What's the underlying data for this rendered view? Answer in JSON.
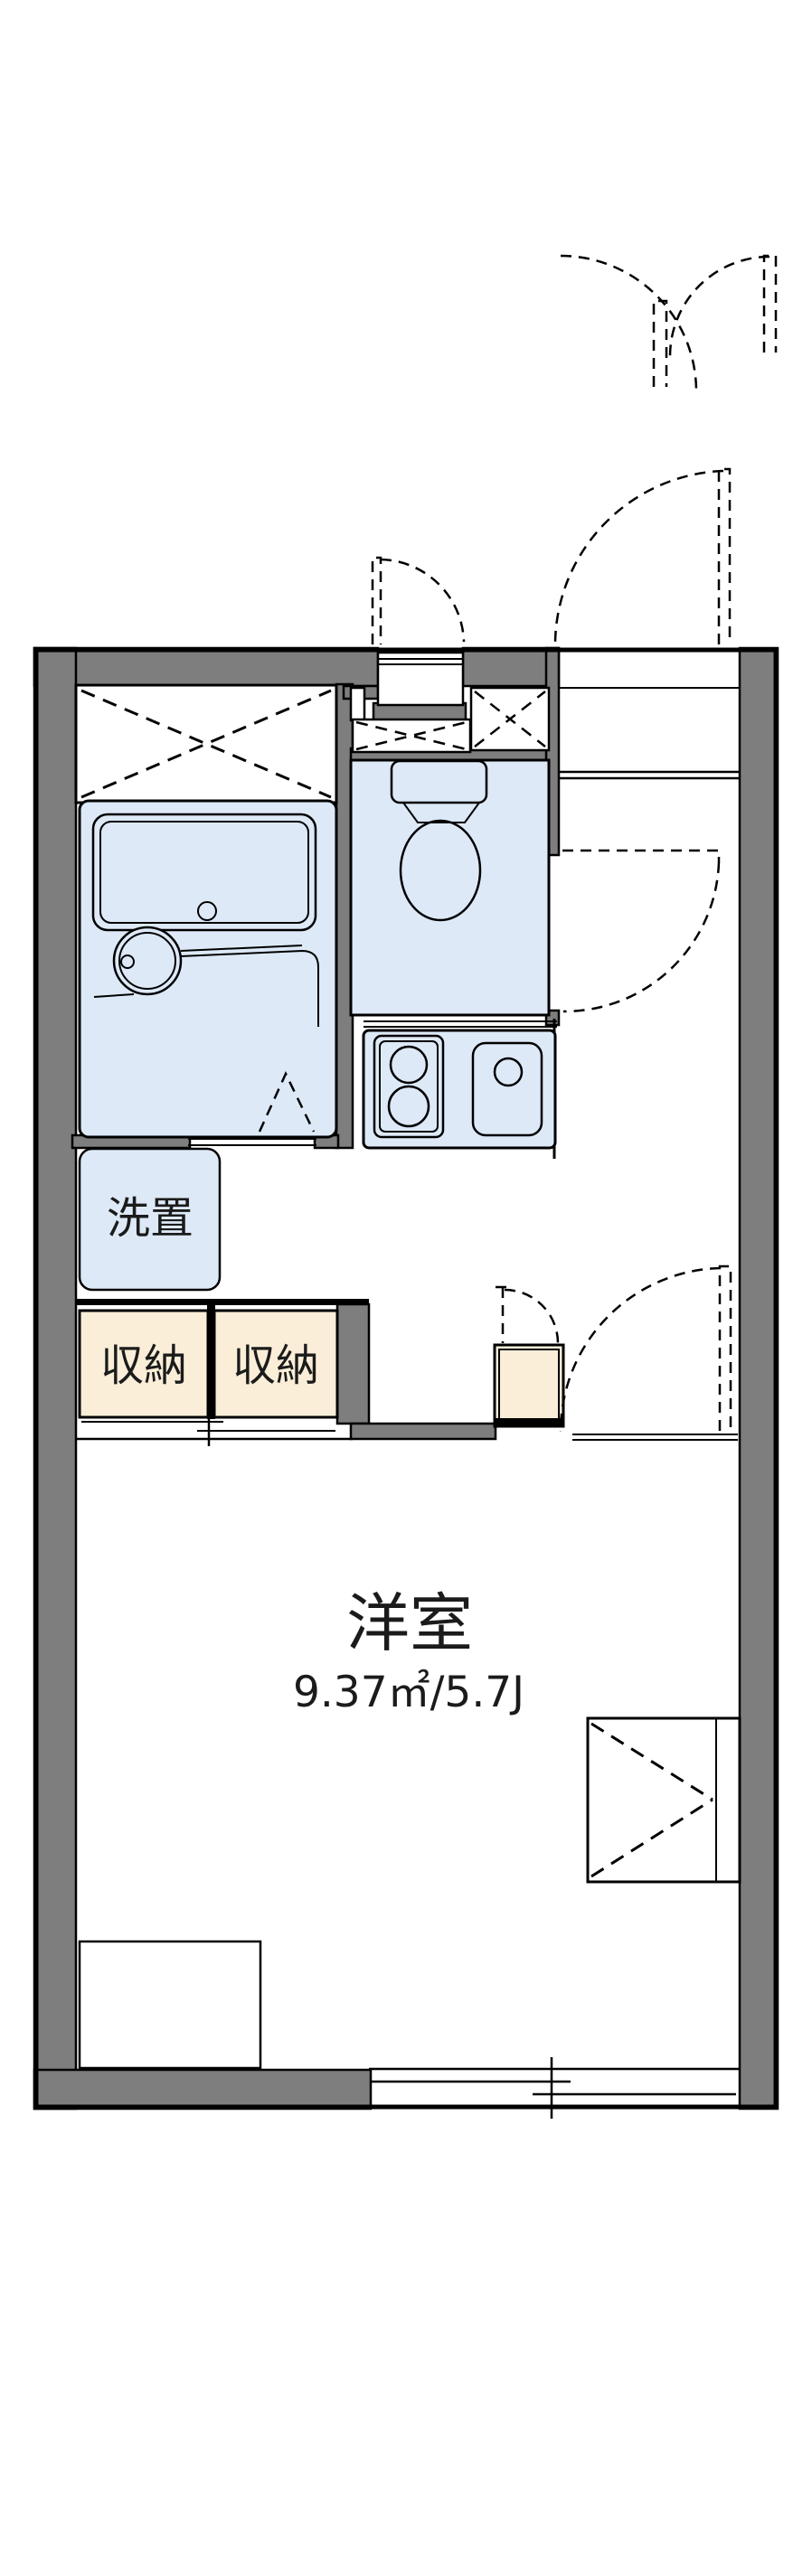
{
  "labels": {
    "washer_space": "洗置",
    "storage_left": "収納",
    "storage_right": "収納",
    "main_room_name": "洋室",
    "main_room_size": "9.37㎡/5.7J"
  },
  "colors": {
    "wall_fill": "#7e7e7e",
    "fixture_fill": "#dde9f7",
    "storage_fill": "#faeed8",
    "line": "#000000",
    "text": "#1b1b1b",
    "background": "#ffffff"
  }
}
